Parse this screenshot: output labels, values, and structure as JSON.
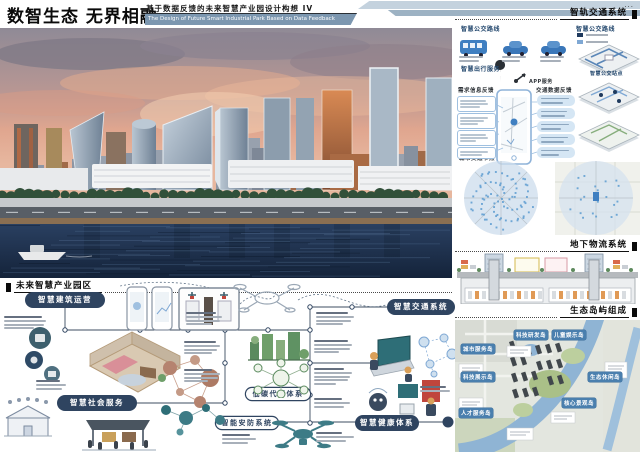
{
  "poster": {
    "title": "数智生态 无界相融",
    "subtitle_cn": "基于数据反馈的未来智慧产业园设计构想 IV",
    "subtitle_en": "The Design of Future Smart Industrial Park Based on Data Feedback",
    "ellipsis": "...",
    "colors": {
      "accent_navy": "#2f4460",
      "steel_blue": "#7c97b0",
      "pill_blue": "#4a7fae",
      "water_navy": "#20334e",
      "sunset_salmon": "#e3a287",
      "eco_green": "#5a8a5e"
    }
  },
  "left_section": {
    "header": "未来智慧产业园区",
    "pills": {
      "building": "智慧建筑运营",
      "social": "智慧社会服务",
      "transport": "智慧交通系统",
      "carbon": "低碳代谢体系",
      "security": "智能安防系统",
      "health": "智慧健康体系"
    }
  },
  "right_section": {
    "rail_header": "智轨交通系统",
    "logistics_header": "地下物流系统",
    "eco_header": "生态岛屿组成",
    "transit": {
      "bus_routes": "智慧公交路线",
      "travel_service": "智慧出行服务",
      "app_service": "APP服务",
      "routes_map": "智慧公交路线",
      "bus_stops": "智慧公交站点",
      "demand_title": "需求信息反馈",
      "feedback_title": "交通数据反馈",
      "nodes_title": "城市交通节点"
    },
    "site_plan_labels": [
      "科技研发岛",
      "儿童娱乐岛",
      "城市服务岛",
      "科技展示岛",
      "人才服务岛",
      "生态休闲岛",
      "核心景观岛"
    ]
  }
}
